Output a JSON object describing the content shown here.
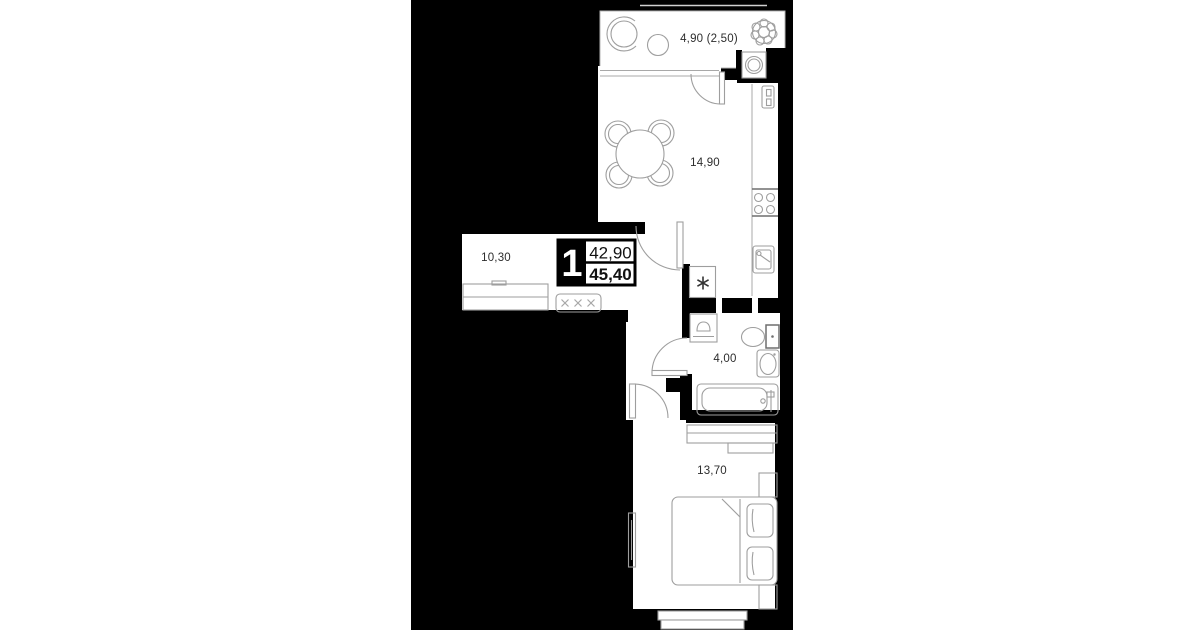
{
  "plan": {
    "type": "apartment-floor-plan",
    "unit_badge": {
      "rooms_count": "1",
      "area_top": "42,90",
      "area_bottom": "45,40"
    },
    "labels": {
      "balcony": "4,90 (2,50)",
      "kitchen_living": "14,90",
      "hallway": "10,30",
      "bathroom": "4,00",
      "bedroom": "13,70"
    },
    "colors": {
      "page_background": "#ffffff",
      "plan_canvas": "#000000",
      "walls": "#000000",
      "furniture_lines": "#9e9e9e",
      "label_text": "#2d2d2d",
      "badge_background": "#000000",
      "badge_text": "#ffffff"
    },
    "icons": [
      "plant-icon",
      "balcony-chair-icon",
      "boiler-icon",
      "dining-table-icon",
      "chair-icon",
      "fridge-icon",
      "stove-icon",
      "kitchen-sink-icon",
      "wardrobe-icon",
      "coat-rack-icon",
      "vent-shaft-icon",
      "washing-machine-icon",
      "toilet-icon",
      "washbasin-icon",
      "bathtub-icon",
      "dresser-icon",
      "tv-icon",
      "bed-icon",
      "pillow-icon",
      "nightstand-icon",
      "window-icon",
      "door-swing-icon"
    ]
  }
}
